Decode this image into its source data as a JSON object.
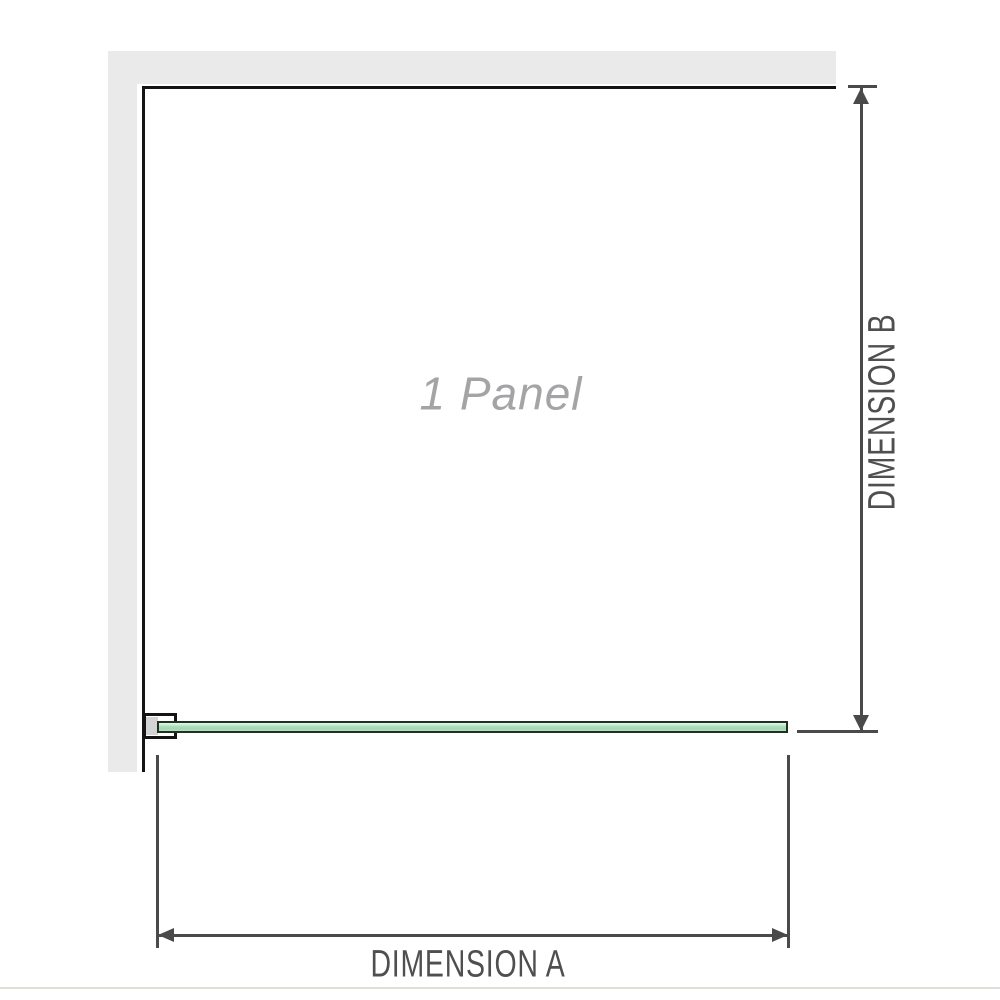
{
  "diagram": {
    "panel_label": "1 Panel",
    "dimension_a": {
      "label": "DIMENSION A",
      "orientation": "horizontal"
    },
    "dimension_b": {
      "label": "DIMENSION B",
      "orientation": "vertical"
    },
    "colors": {
      "wall_fill": "#eaeaea",
      "wall_edge": "#141414",
      "dimension_line": "#4a4a4a",
      "dimension_text": "#4f4f4f",
      "panel_label_text": "#a4a4a6",
      "glass_border": "#22311f",
      "glass_fill_light": "#e7f5eb",
      "glass_fill_mid": "#aadcbb",
      "glass_fill_deep": "#9fd8b3",
      "bracket_fill": "#d4d4d4",
      "baseline": "#dfdfda"
    }
  }
}
